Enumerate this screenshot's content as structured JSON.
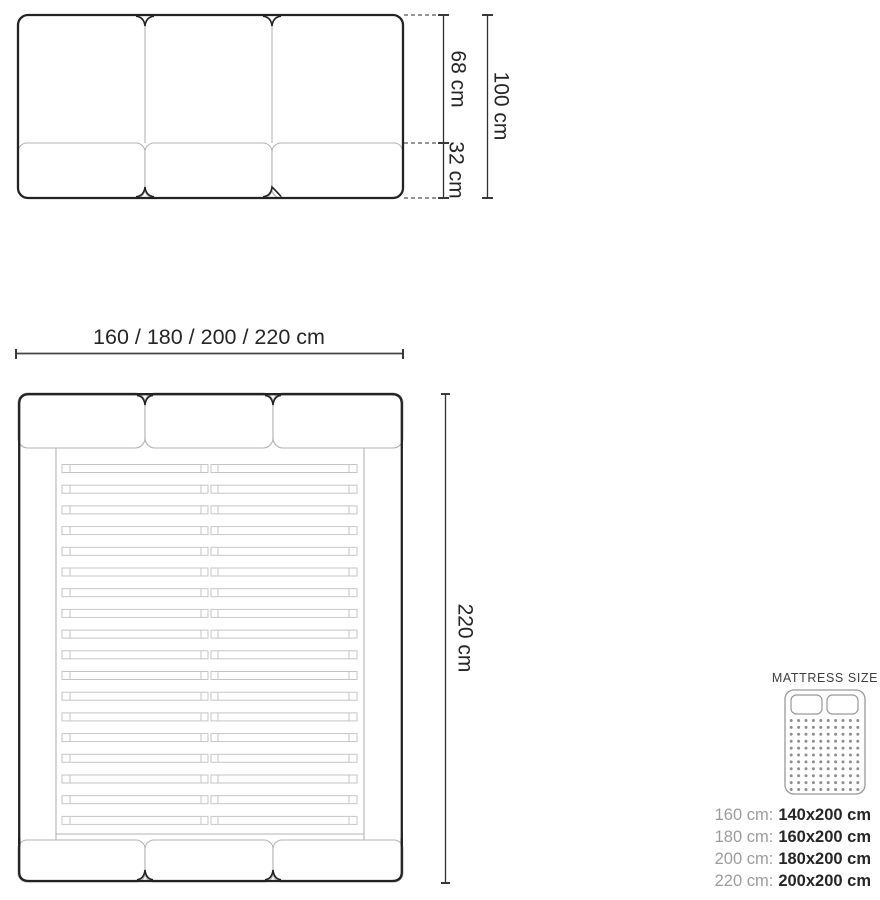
{
  "front_view": {
    "upper_height_label": "68 cm",
    "lower_height_label": "32 cm",
    "total_height_label": "100 cm"
  },
  "top_view": {
    "width_label": "160 / 180 / 200 / 220 cm",
    "length_label": "220 cm",
    "slat_rows": 18
  },
  "legend": {
    "title": "MATTRESS SIZE",
    "rows": [
      {
        "frame": "160 cm:",
        "mattress": "140x200 cm"
      },
      {
        "frame": "180 cm:",
        "mattress": "160x200 cm"
      },
      {
        "frame": "200 cm:",
        "mattress": "180x200 cm"
      },
      {
        "frame": "220 cm:",
        "mattress": "200x200 cm"
      }
    ],
    "dot_grid": {
      "cols": 10,
      "rows": 11
    }
  },
  "colors": {
    "outline_dark": "#232323",
    "outline_light": "#b3b3b3",
    "slat_gray": "#c6c6c6",
    "dimension_line": "#303030",
    "text_dark": "#262626",
    "text_gray": "#9c9c9c",
    "dot_gray": "#8f8f8f"
  }
}
